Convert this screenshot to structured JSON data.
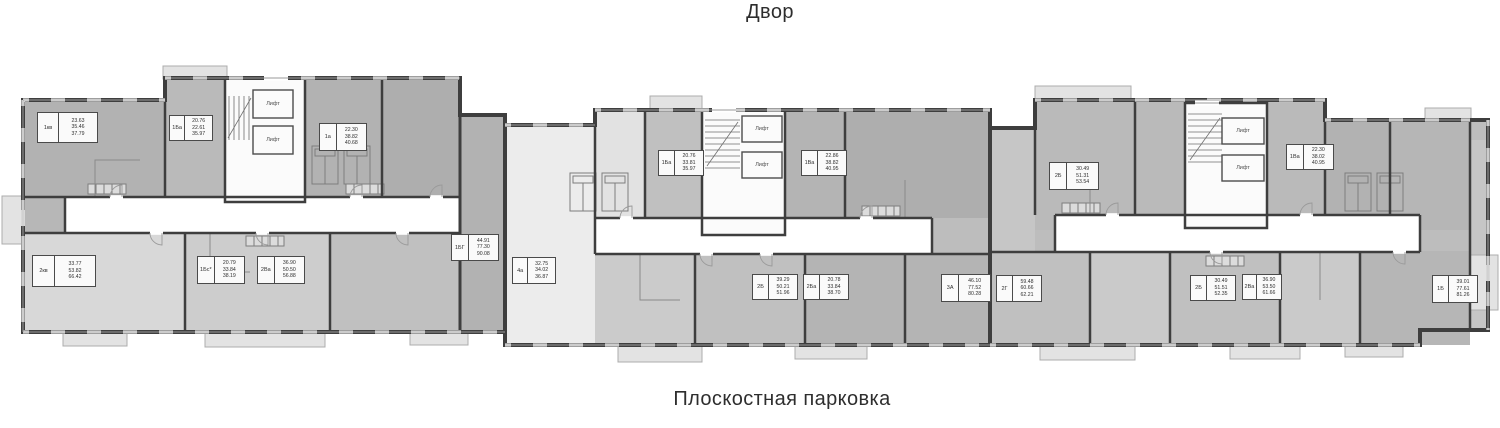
{
  "labels": {
    "top": "Двор",
    "bottom": "Плоскостная парковка",
    "lift": "Лифт"
  },
  "lifts": [
    {
      "x": 273,
      "y": 104
    },
    {
      "x": 273,
      "y": 140
    },
    {
      "x": 762,
      "y": 129
    },
    {
      "x": 762,
      "y": 165
    },
    {
      "x": 1243,
      "y": 131
    },
    {
      "x": 1243,
      "y": 168
    }
  ],
  "units": [
    {
      "type": "1кв",
      "areas": [
        "23.63",
        "35.46",
        "37.79"
      ],
      "x": 37,
      "y": 112,
      "w": 61,
      "h": 31
    },
    {
      "type": "1Ба",
      "areas": [
        "20.76",
        "22.61",
        "35.97"
      ],
      "x": 169,
      "y": 115,
      "w": 44,
      "h": 26
    },
    {
      "type": "1а",
      "areas": [
        "22.30",
        "38.82",
        "40.68"
      ],
      "x": 319,
      "y": 123,
      "w": 48,
      "h": 28
    },
    {
      "type": "1БГ",
      "areas": [
        "44.91",
        "77.30",
        "90.08"
      ],
      "x": 451,
      "y": 234,
      "w": 48,
      "h": 27
    },
    {
      "type": "2кв",
      "areas": [
        "33.77",
        "53.82",
        "66.42"
      ],
      "x": 32,
      "y": 255,
      "w": 64,
      "h": 32
    },
    {
      "type": "1Бс*",
      "areas": [
        "20.79",
        "33.84",
        "38.19"
      ],
      "x": 197,
      "y": 256,
      "w": 48,
      "h": 28
    },
    {
      "type": "2Ва",
      "areas": [
        "36.90",
        "50.50",
        "56.88"
      ],
      "x": 257,
      "y": 256,
      "w": 48,
      "h": 28
    },
    {
      "type": "4а",
      "areas": [
        "32.75",
        "34.02",
        "36.87"
      ],
      "x": 512,
      "y": 257,
      "w": 44,
      "h": 27
    },
    {
      "type": "1Ба",
      "areas": [
        "20.76",
        "33.81",
        "35.97"
      ],
      "x": 658,
      "y": 150,
      "w": 46,
      "h": 26
    },
    {
      "type": "1Ва",
      "areas": [
        "22.86",
        "38.82",
        "40.95"
      ],
      "x": 801,
      "y": 150,
      "w": 46,
      "h": 26
    },
    {
      "type": "2Б",
      "areas": [
        "39.29",
        "50.21",
        "51.96"
      ],
      "x": 752,
      "y": 274,
      "w": 46,
      "h": 26
    },
    {
      "type": "2Ба",
      "areas": [
        "20.78",
        "33.84",
        "38.70"
      ],
      "x": 803,
      "y": 274,
      "w": 46,
      "h": 26
    },
    {
      "type": "3А",
      "areas": [
        "46.10",
        "77.52",
        "80.28"
      ],
      "x": 941,
      "y": 274,
      "w": 50,
      "h": 28
    },
    {
      "type": "2Г",
      "areas": [
        "59.48",
        "60.66",
        "62.21"
      ],
      "x": 996,
      "y": 275,
      "w": 46,
      "h": 27
    },
    {
      "type": "2Б",
      "areas": [
        "30.49",
        "51.31",
        "53.54"
      ],
      "x": 1049,
      "y": 162,
      "w": 50,
      "h": 28
    },
    {
      "type": "2Б",
      "areas": [
        "30.49",
        "51.51",
        "52.35"
      ],
      "x": 1190,
      "y": 275,
      "w": 46,
      "h": 26
    },
    {
      "type": "2Ва",
      "areas": [
        "36.90",
        "53.50",
        "61.66"
      ],
      "x": 1242,
      "y": 274,
      "w": 40,
      "h": 26
    },
    {
      "type": "1Ва",
      "areas": [
        "22.30",
        "38.02",
        "40.95"
      ],
      "x": 1286,
      "y": 144,
      "w": 48,
      "h": 26
    },
    {
      "type": "1Б",
      "areas": [
        "39.01",
        "77.61",
        "81.26"
      ],
      "x": 1432,
      "y": 275,
      "w": 46,
      "h": 28
    }
  ],
  "colors": {
    "background": "#ffffff",
    "wall": "#3e3e3e",
    "unit_fill_dark": "#aeaeae",
    "unit_fill_medium": "#c0c0c0",
    "unit_fill_light": "#d8d8d8",
    "unit_fill_pale": "#ececec",
    "balcony": "#e3e3e3",
    "corridor": "#ffffff",
    "label_box_bg": "#fafafa",
    "label_box_border": "#4a4a4a",
    "text": "#2e2e2e"
  }
}
